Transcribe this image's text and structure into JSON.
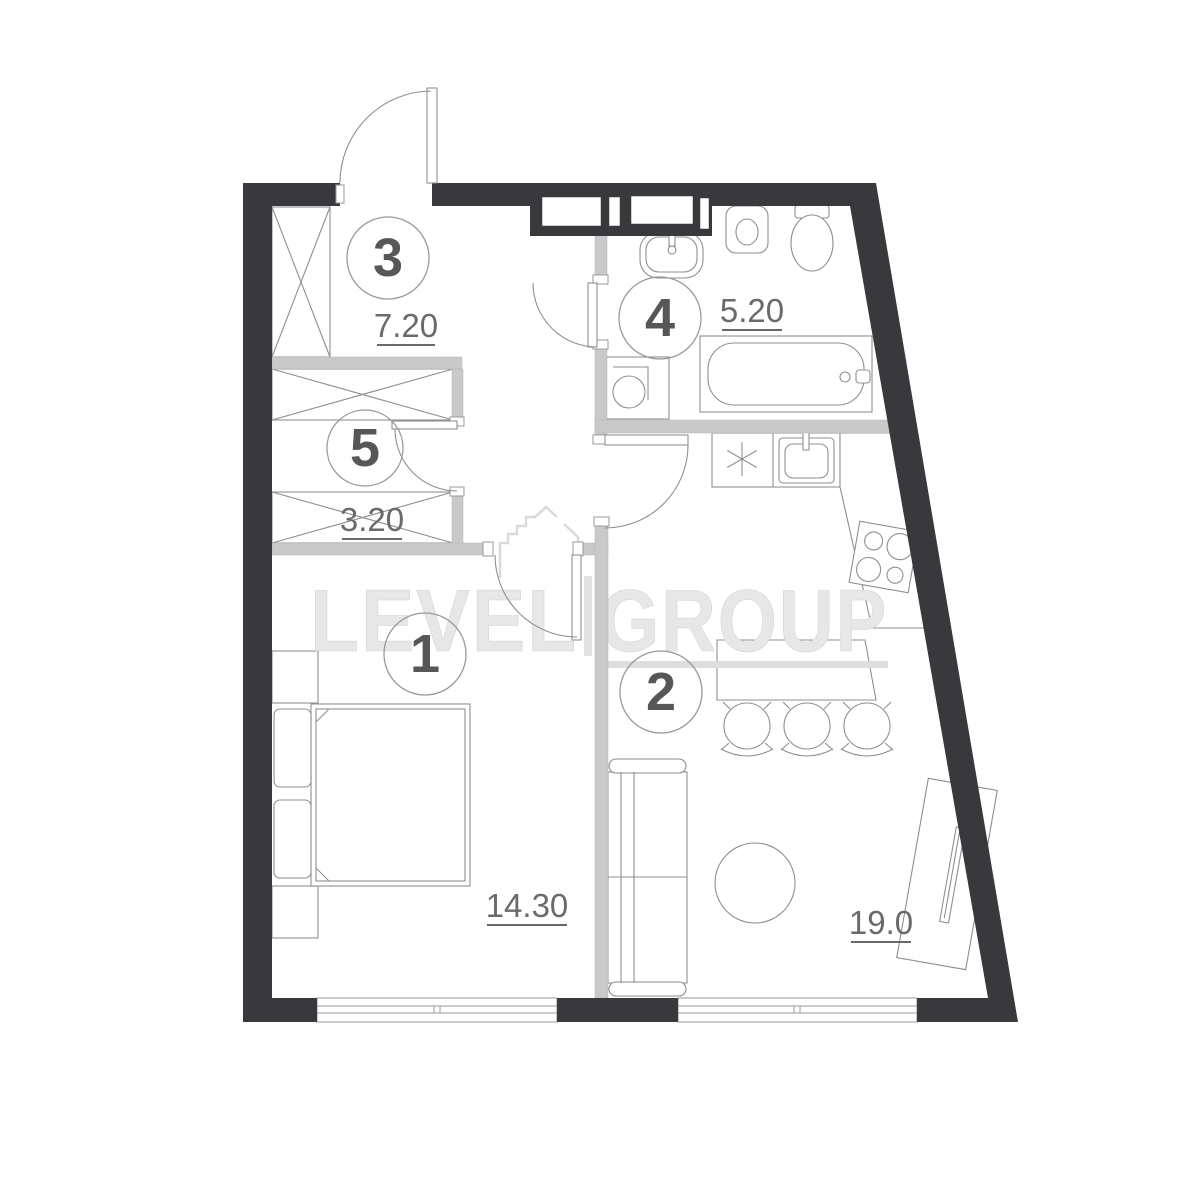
{
  "watermark": {
    "left": "LEVEL",
    "right": "GROUP"
  },
  "rooms": {
    "bedroom": {
      "number": "1",
      "area": "14.30"
    },
    "living_kitchen": {
      "number": "2",
      "area": "19.0"
    },
    "hallway": {
      "number": "3",
      "area": "7.20"
    },
    "bathroom": {
      "number": "4",
      "area": "5.20"
    },
    "wardrobe": {
      "number": "5",
      "area": "3.20"
    }
  },
  "colors": {
    "exterior_wall": "#39383d",
    "partition_wall": "#c9c9c9",
    "furniture_line": "#8f8f8f",
    "label_text": "#6a6a6a",
    "room_number_text": "#575757",
    "watermark": "#e7e7e7"
  }
}
